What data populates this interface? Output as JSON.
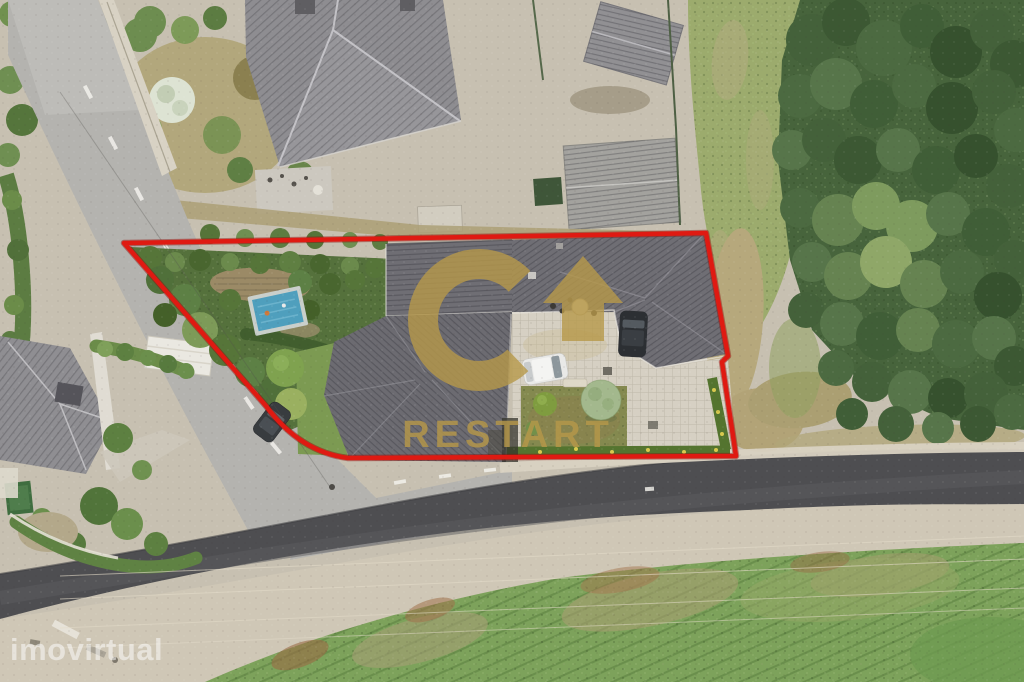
{
  "meta": {
    "kind": "aerial-drone-listing-photo",
    "width": 1024,
    "height": 682
  },
  "watermarks": {
    "agency_logo_text": "RESTART",
    "listing_portal_text": "imovirtual"
  },
  "colors": {
    "boundary_red": "#df1a12",
    "logo_gold": "#b6984a",
    "portal_watermark_white": "#ffffff"
  }
}
